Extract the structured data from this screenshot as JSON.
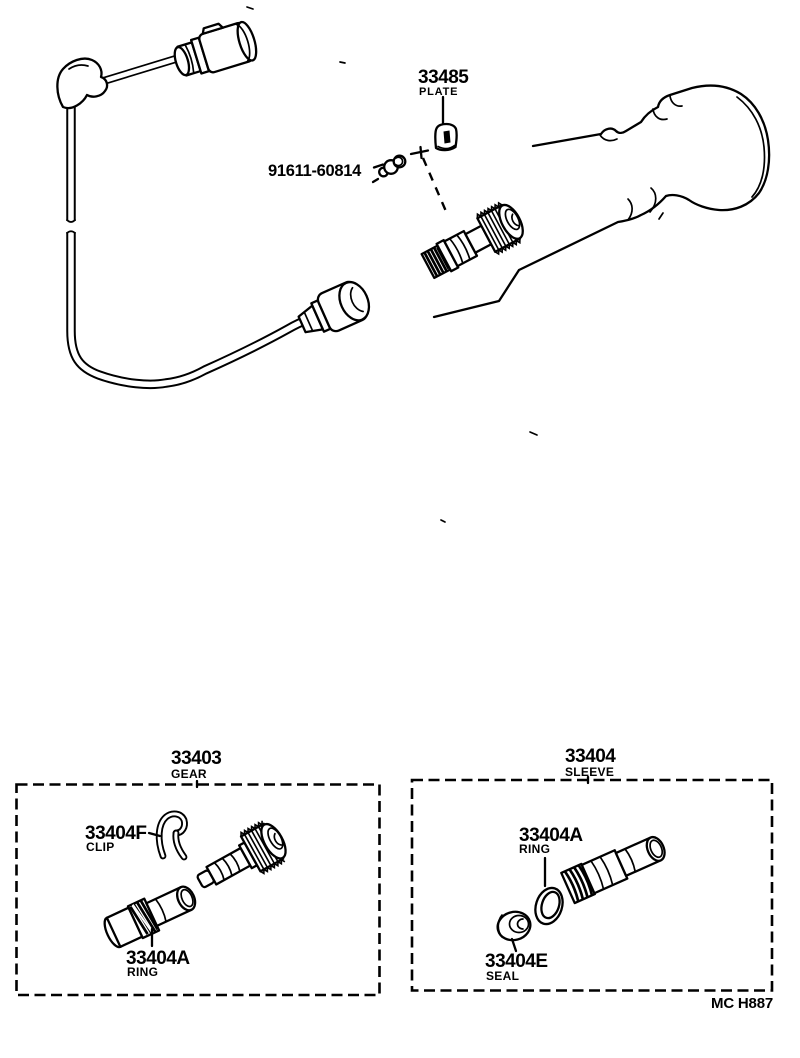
{
  "colors": {
    "ink": "#000000",
    "paper": "#ffffff"
  },
  "footer": {
    "doc_code": "MC H887"
  },
  "callouts": {
    "plate": {
      "code": "33485",
      "name": "PLATE"
    },
    "bolt": {
      "code": "91611-60814"
    },
    "gear_group": {
      "code": "33403",
      "name": "GEAR"
    },
    "sleeve_group": {
      "code": "33404",
      "name": "SLEEVE"
    },
    "clip": {
      "code": "33404F",
      "name": "CLIP"
    },
    "gear_group_ring": {
      "code": "33404A",
      "name": "RING"
    },
    "sleeve_group_ring": {
      "code": "33404A",
      "name": "RING"
    },
    "seal": {
      "code": "33404E",
      "name": "SEAL"
    }
  }
}
